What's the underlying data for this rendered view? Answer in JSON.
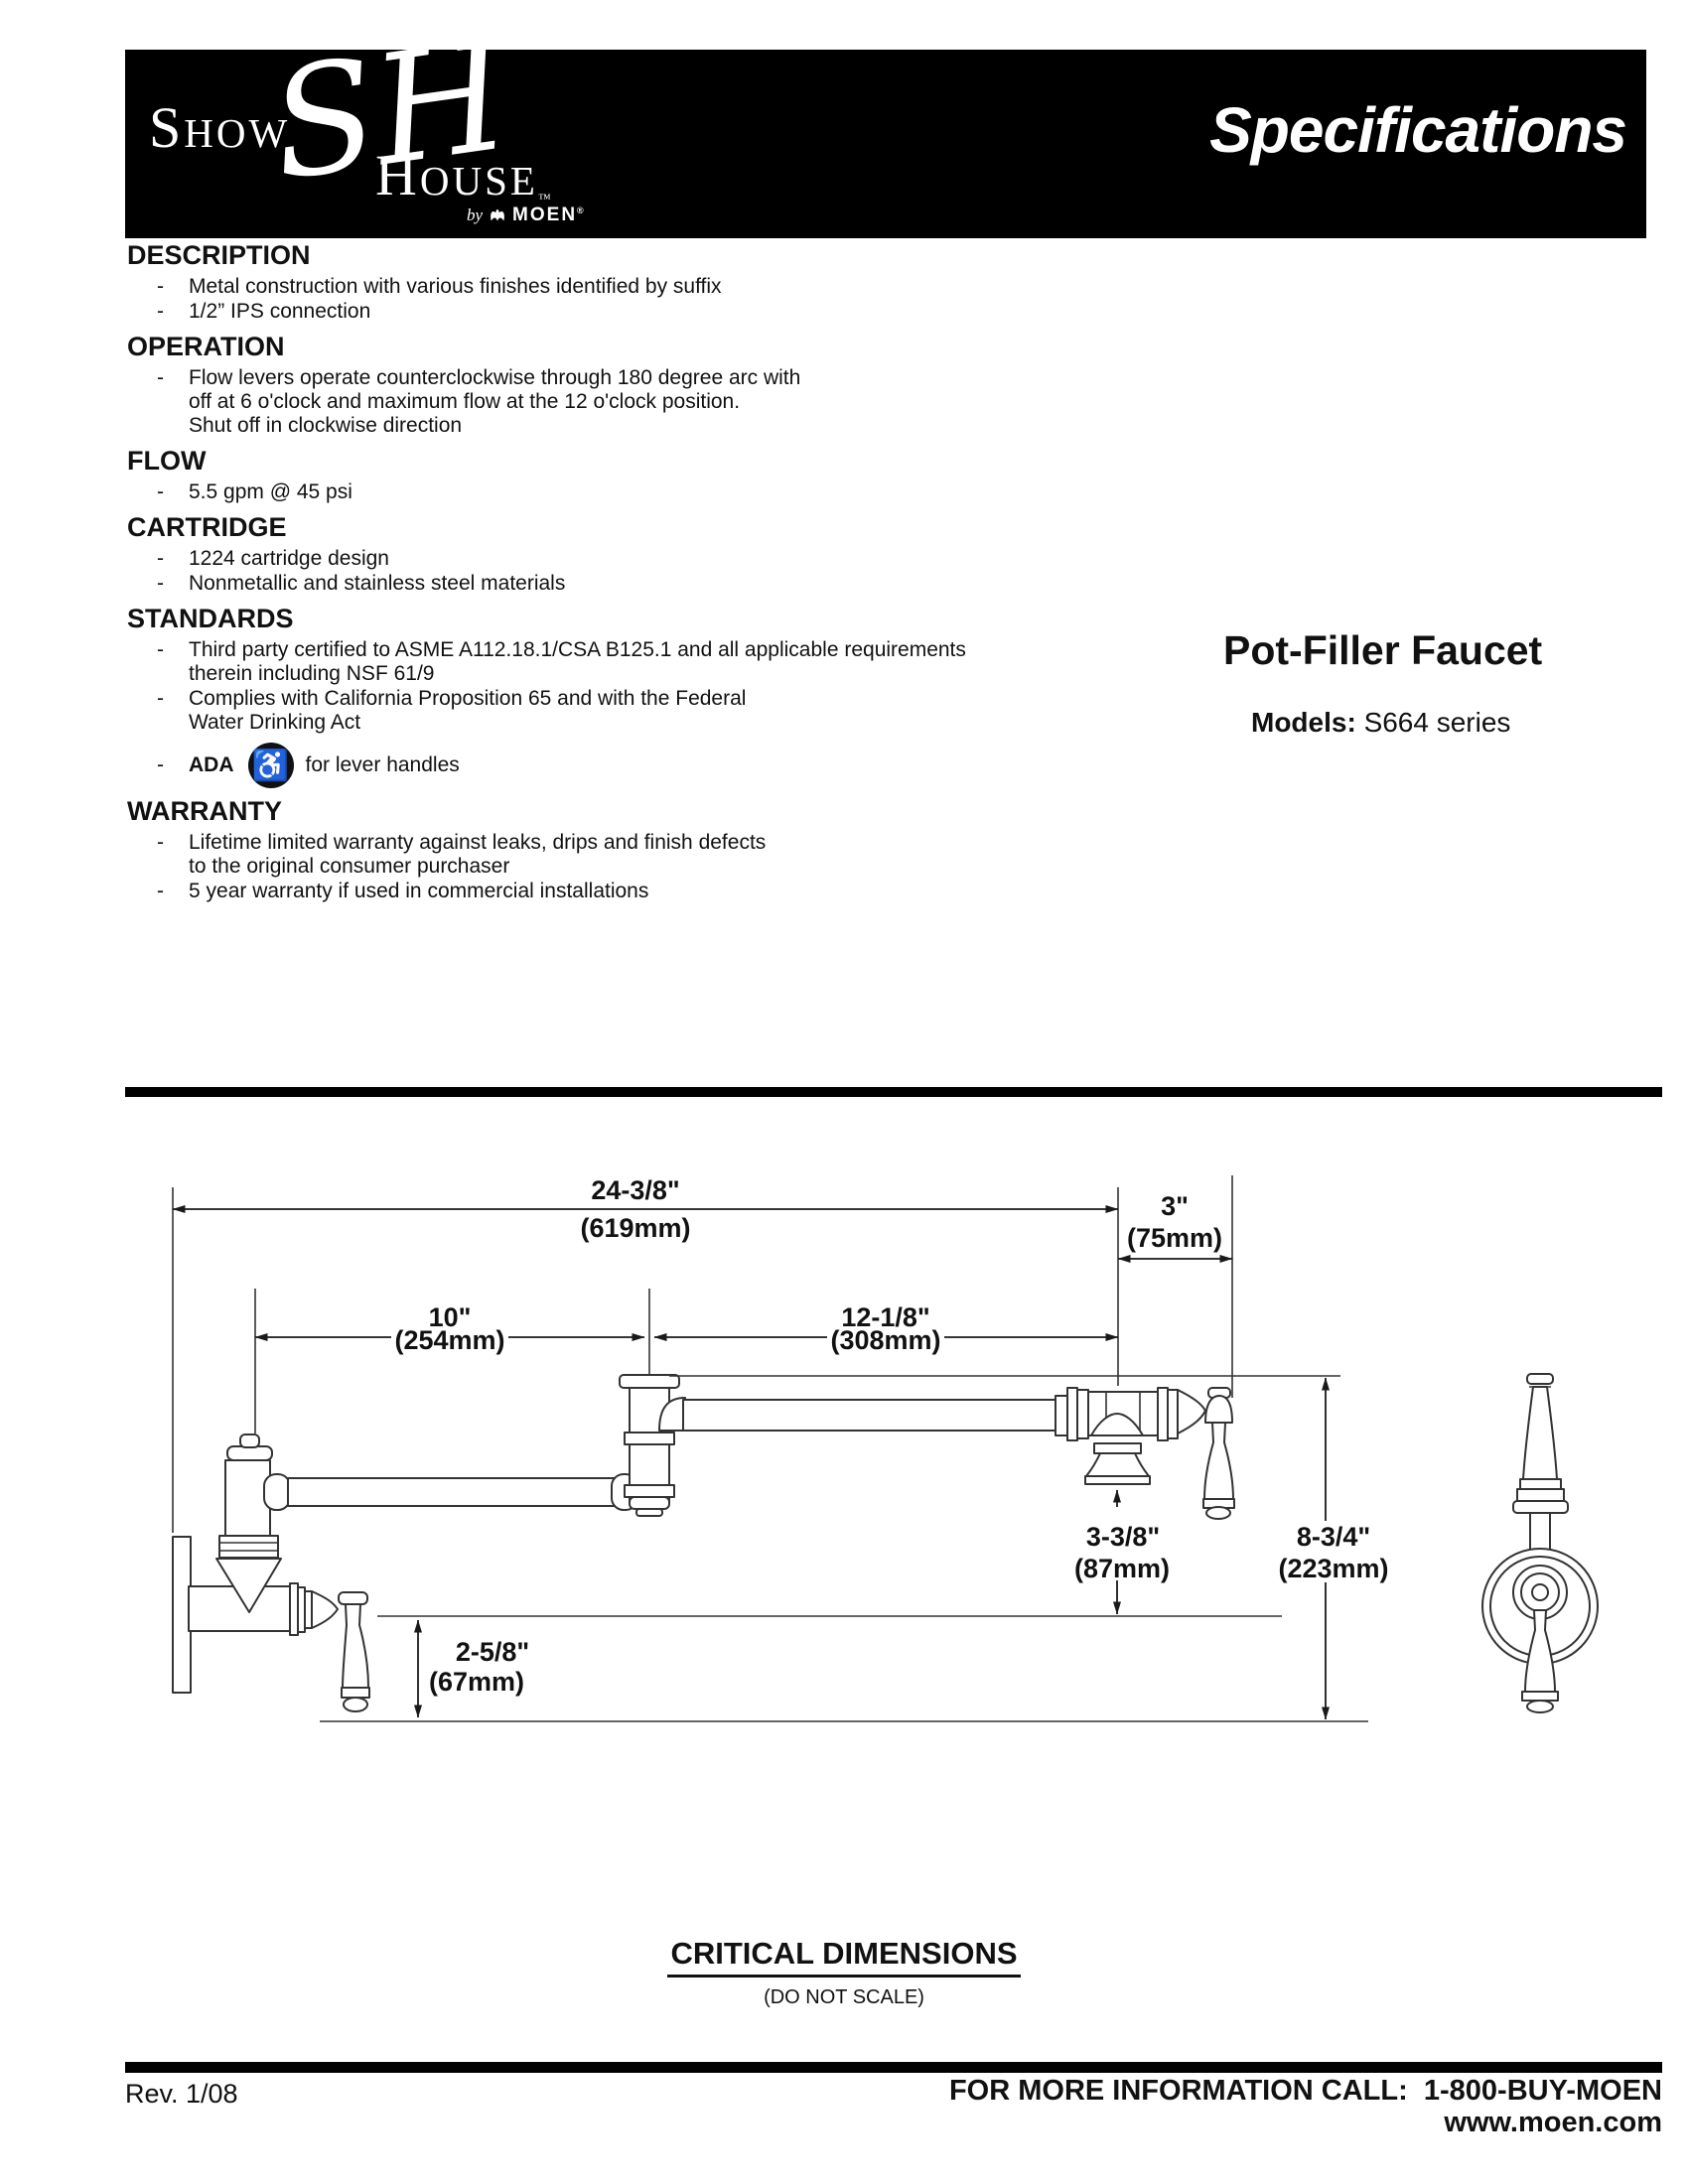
{
  "dash": "-",
  "header": {
    "title": "Specifications",
    "logo": {
      "show": "Show",
      "monogram": "SH",
      "house": "House",
      "tm": "™",
      "by": "by",
      "brand": "MOEN",
      "reg": "®"
    }
  },
  "sections": [
    {
      "heading": "DESCRIPTION",
      "bullets": [
        {
          "lines": [
            "Metal construction with various finishes identified by suffix"
          ]
        },
        {
          "lines": [
            "1/2” IPS connection"
          ]
        }
      ]
    },
    {
      "heading": "OPERATION",
      "bullets": [
        {
          "lines": [
            "Flow levers operate counterclockwise through 180 degree arc with",
            "off at 6 o'clock and maximum flow at the 12 o'clock position.",
            "Shut off in clockwise direction"
          ]
        }
      ]
    },
    {
      "heading": "FLOW",
      "bullets": [
        {
          "lines": [
            "5.5 gpm @ 45 psi"
          ]
        }
      ]
    },
    {
      "heading": "CARTRIDGE",
      "bullets": [
        {
          "lines": [
            "1224 cartridge design"
          ]
        },
        {
          "lines": [
            "Nonmetallic and stainless steel materials"
          ]
        }
      ]
    },
    {
      "heading": "STANDARDS",
      "bullets": [
        {
          "lines": [
            "Third party certified to ASME A112.18.1/CSA B125.1 and all applicable requirements",
            "therein including NSF 61/9"
          ]
        },
        {
          "lines": [
            "Complies with California Proposition 65 and with the Federal",
            "Water Drinking Act"
          ]
        },
        {
          "ada": "ADA",
          "wheelchair_glyph": "♿",
          "rest": "for lever handles"
        }
      ]
    },
    {
      "heading": "WARRANTY",
      "bullets": [
        {
          "lines": [
            "Lifetime limited warranty against leaks, drips and finish defects",
            "to the original consumer purchaser"
          ]
        },
        {
          "lines": [
            "5 year warranty if used in commercial installations"
          ]
        }
      ]
    }
  ],
  "product": {
    "title": "Pot-Filler Faucet",
    "models_label": "Models:",
    "models_value": "S664 series"
  },
  "dims": {
    "reach": {
      "in": "24-3/8\"",
      "mm": "(619mm)"
    },
    "offset": {
      "in": "3\"",
      "mm": "(75mm)"
    },
    "arm1": {
      "in": "10\"",
      "mm": "(254mm)"
    },
    "arm2": {
      "in": "12-1/8\"",
      "mm": "(308mm)"
    },
    "clearance": {
      "in": "3-3/8\"",
      "mm": "(87mm)"
    },
    "height": {
      "in": "8-3/4\"",
      "mm": "(223mm)"
    },
    "drop": {
      "in": "2-5/8\"",
      "mm": "(67mm)"
    }
  },
  "caption": {
    "title": "CRITICAL DIMENSIONS",
    "note": "(DO NOT SCALE)"
  },
  "footer": {
    "rev": "Rev. 1/08",
    "info": "FOR MORE INFORMATION CALL:  1-800-BUY-MOEN",
    "site": "www.moen.com"
  },
  "colors": {
    "bar": "#000000",
    "text": "#111111",
    "line": "#333333"
  }
}
